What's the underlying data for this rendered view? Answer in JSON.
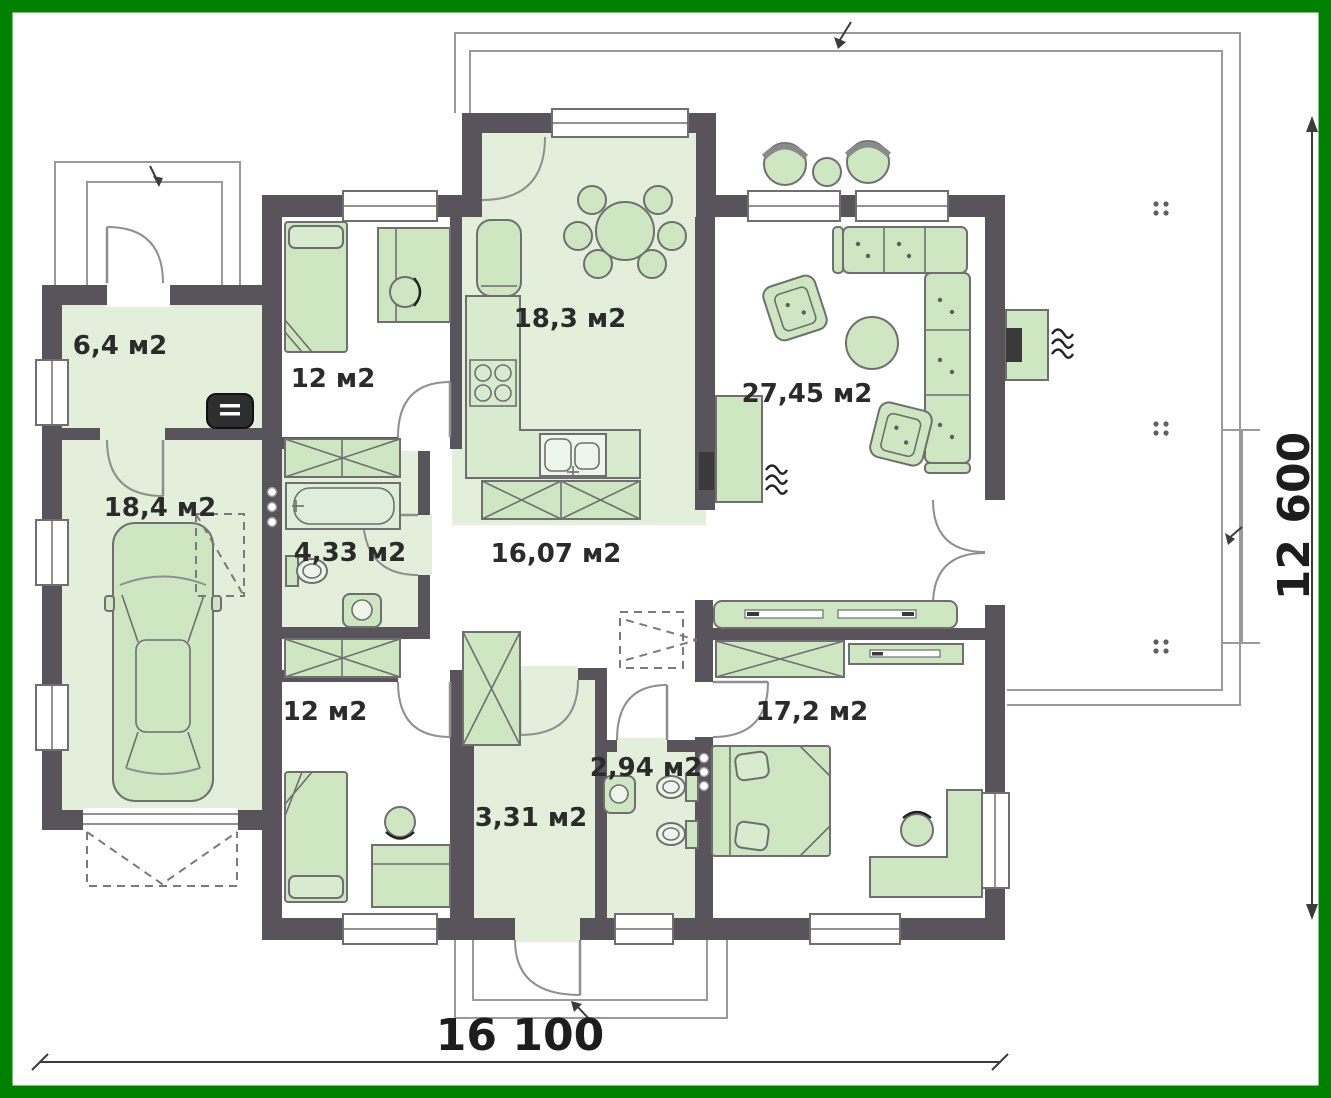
{
  "document": {
    "kind": "architectural-floor-plan",
    "view": "single-storey house plan with garage and wrap terrace"
  },
  "rooms": [
    {
      "name": "vestibule",
      "area": "6,4 м2"
    },
    {
      "name": "bedroom-top",
      "area": "12 м2"
    },
    {
      "name": "kitchen-dining",
      "area": "18,3 м2"
    },
    {
      "name": "living-room",
      "area": "27,45 м2"
    },
    {
      "name": "garage",
      "area": "18,4 м2"
    },
    {
      "name": "bathroom",
      "area": "4,33 м2"
    },
    {
      "name": "hallway",
      "area": "16,07 м2"
    },
    {
      "name": "bedroom-bottom",
      "area": "12 м2"
    },
    {
      "name": "entry-storage",
      "area": "3,31 м2"
    },
    {
      "name": "wc",
      "area": "2,94 м2"
    },
    {
      "name": "bedroom-master",
      "area": "17,2 м2"
    }
  ],
  "dimensions": {
    "width": "16 100",
    "height": "12 600"
  },
  "colors": {
    "frame_border": "#008000",
    "walls": "#59545b",
    "room_fill": "#e3efda",
    "furniture_fill": "#cfe6c3",
    "outline": "#6f6f6f",
    "terrace_line": "#9a9a9a",
    "attic_hatch_fill": "#f8f4e1",
    "text": "#2b2b2b"
  },
  "furniture": [
    "car",
    "single-bed",
    "double-bed",
    "desk",
    "office-chair",
    "dining-table",
    "dining-chair",
    "fridge",
    "stove",
    "kitchen-counter",
    "kitchen-sink",
    "corner-sofa",
    "armchair",
    "coffee-table",
    "tv-unit",
    "sideboard",
    "sliding-wardrobe",
    "wardrobe",
    "dresser",
    "bathtub",
    "toilet",
    "bidet",
    "washbasin",
    "boiler",
    "outdoor-fireplace",
    "garden-chair",
    "garden-table"
  ],
  "features": [
    "terrace",
    "main-entrance-porch",
    "side-entrance-porch",
    "garage-apron",
    "attic-hatch-ladder",
    "ventilation-stack",
    "dimension-lines"
  ]
}
